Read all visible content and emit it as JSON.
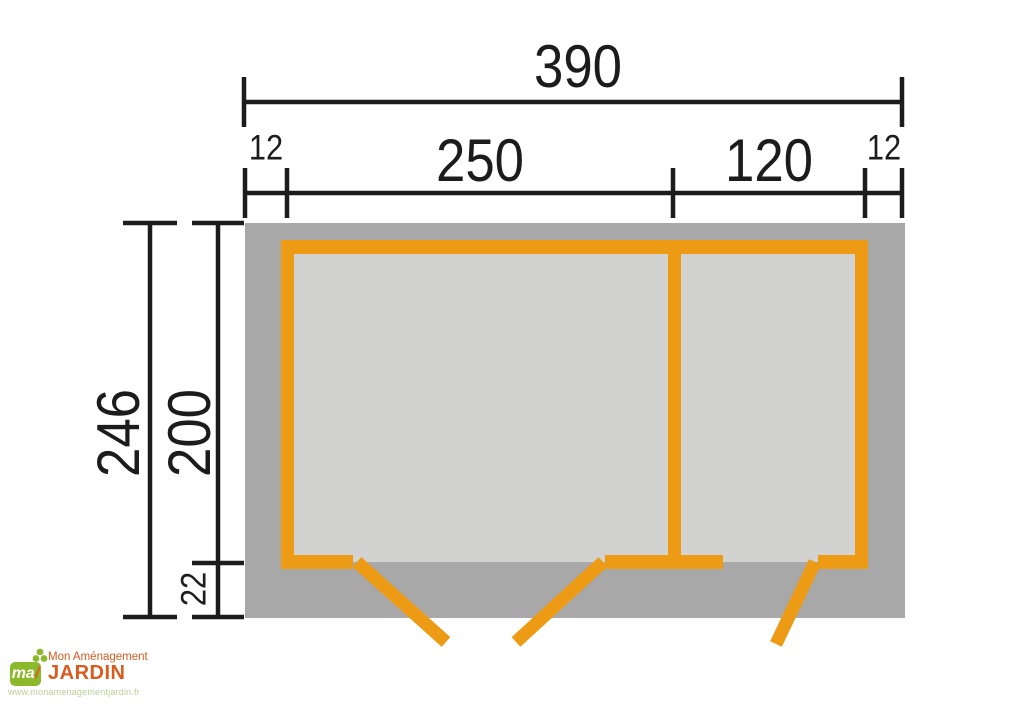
{
  "diagram": {
    "type": "floor-plan",
    "description": "Garden shed floor plan, top view, two rooms with outward-swinging doors",
    "dimensions": {
      "top": {
        "total_width": "390"
      },
      "row2": {
        "left_overhang": "12",
        "room1_width": "250",
        "room2_width": "120",
        "right_overhang": "12"
      },
      "left": {
        "total_depth": "246",
        "inner_depth": "200",
        "base_offset": "22"
      }
    },
    "rooms": [
      {
        "name": "room-1",
        "width_label": "250"
      },
      {
        "name": "room-2",
        "width_label": "120"
      }
    ]
  },
  "logo": {
    "mark": "ma",
    "brand_top": "Mon Aménagement",
    "brand_main": "JARDIN",
    "website": "www.monamenagementjardin.fr"
  },
  "palette": {
    "wall_orange": "#ED9A15",
    "ground_gray": "#A8A8A8",
    "floor_gray": "#D2D2D0",
    "line_black": "#1C1C1C",
    "brand_orange": "#D95B1E",
    "brand_green": "#8CB92C",
    "url_green": "#BCCF96"
  }
}
